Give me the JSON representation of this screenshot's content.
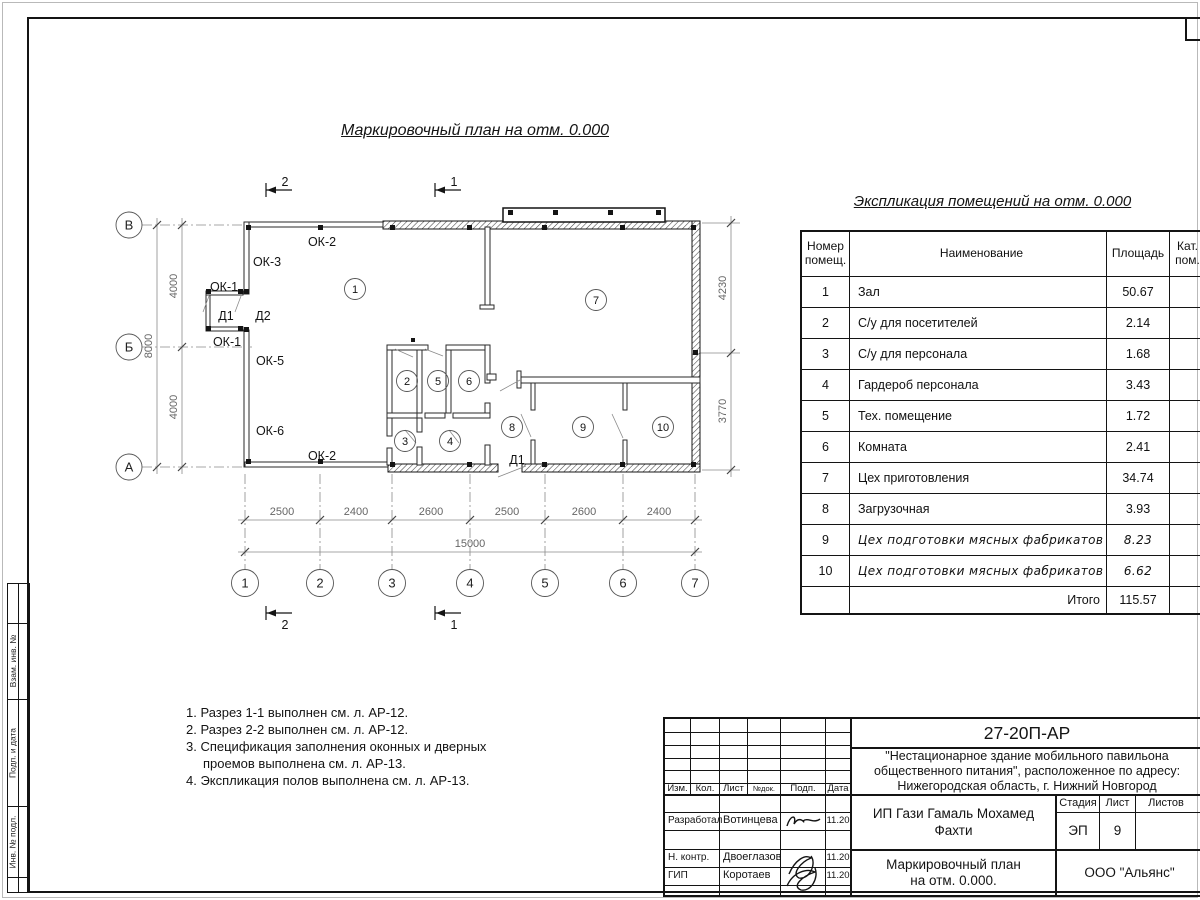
{
  "plan": {
    "title": "Маркировочный план на отм. 0.000",
    "row_axes": [
      "В",
      "Б",
      "А"
    ],
    "col_axes": [
      "1",
      "2",
      "3",
      "4",
      "5",
      "6",
      "7"
    ],
    "dims_bottom": [
      "2500",
      "2400",
      "2600",
      "2500",
      "2600",
      "2400"
    ],
    "dim_total": "15000",
    "dims_left": [
      "4000",
      "4000"
    ],
    "dim_left_total": "8000",
    "dims_right": [
      "4230",
      "3770"
    ],
    "sections": {
      "s1": "1",
      "s2": "2"
    },
    "openings": {
      "ok1": "ОК-1",
      "ok2": "ОК-2",
      "ok3": "ОК-3",
      "ok5": "ОК-5",
      "ok6": "ОК-6",
      "d1": "Д1",
      "d2": "Д2"
    },
    "rooms": [
      "1",
      "2",
      "3",
      "4",
      "5",
      "6",
      "7",
      "8",
      "9",
      "10"
    ]
  },
  "table": {
    "title": "Экспликация помещений на отм. 0.000",
    "col_num": "Номер помещ.",
    "col_name": "Наименование",
    "col_area": "Площадь",
    "col_cat": "Кат. пом.",
    "rows": [
      {
        "n": "1",
        "name": "Зал",
        "area": "50.67"
      },
      {
        "n": "2",
        "name": "С/у для посетителей",
        "area": "2.14"
      },
      {
        "n": "3",
        "name": "С/у для персонала",
        "area": "1.68"
      },
      {
        "n": "4",
        "name": "Гардероб персонала",
        "area": "3.43"
      },
      {
        "n": "5",
        "name": "Тех. помещение",
        "area": "1.72"
      },
      {
        "n": "6",
        "name": "Комната",
        "area": "2.41"
      },
      {
        "n": "7",
        "name": "Цех приготовления",
        "area": "34.74"
      },
      {
        "n": "8",
        "name": "Загрузочная",
        "area": "3.93"
      },
      {
        "n": "9",
        "name": "Цех подготовки мясных фабрикатов",
        "area": "8.23"
      },
      {
        "n": "10",
        "name": "Цех подготовки мясных фабрикатов",
        "area": "6.62"
      }
    ],
    "total_label": "Итого",
    "total_area": "115.57"
  },
  "notes": [
    "1. Разрез 1-1 выполнен см. л. АР-12.",
    "2. Разрез 2-2 выполнен см. л. АР-12.",
    "3. Спецификация заполнения оконных и дверных проемов выполнена см. л. АР-13.",
    "4. Экспликация полов выполнена см. л. АР-13."
  ],
  "stamp_strip": [
    "Взам. инв. №",
    "Подп. и дата",
    "Инв. № подл."
  ],
  "title_block": {
    "code": "27-20П-АР",
    "description": "\"Нестационарное здание мобильного павильона общественного питания\", расположенное по адресу: Нижегородская область, г. Нижний Новгород",
    "client": "ИП Гази Гамаль Мохамед Фахти",
    "cols": {
      "izm": "Изм.",
      "kol": "Кол.",
      "list": "Лист",
      "ndok": "№док.",
      "podp": "Подп.",
      "data": "Дата"
    },
    "stage_label": "Стадия",
    "sheet_label": "Лист",
    "sheets_label": "Листов",
    "stage": "ЭП",
    "sheet": "9",
    "sheets": "",
    "drawing_title": "Маркировочный план на отм. 0.000.",
    "company": "ООО \"Альянс\"",
    "staff": [
      {
        "role": "Разработал",
        "name": "Вотинцева",
        "date": "11.20"
      },
      {
        "role": "Н. контр.",
        "name": "Двоеглазов",
        "date": "11.20"
      },
      {
        "role": "ГИП",
        "name": "Коротаев",
        "date": "11.20"
      }
    ]
  }
}
